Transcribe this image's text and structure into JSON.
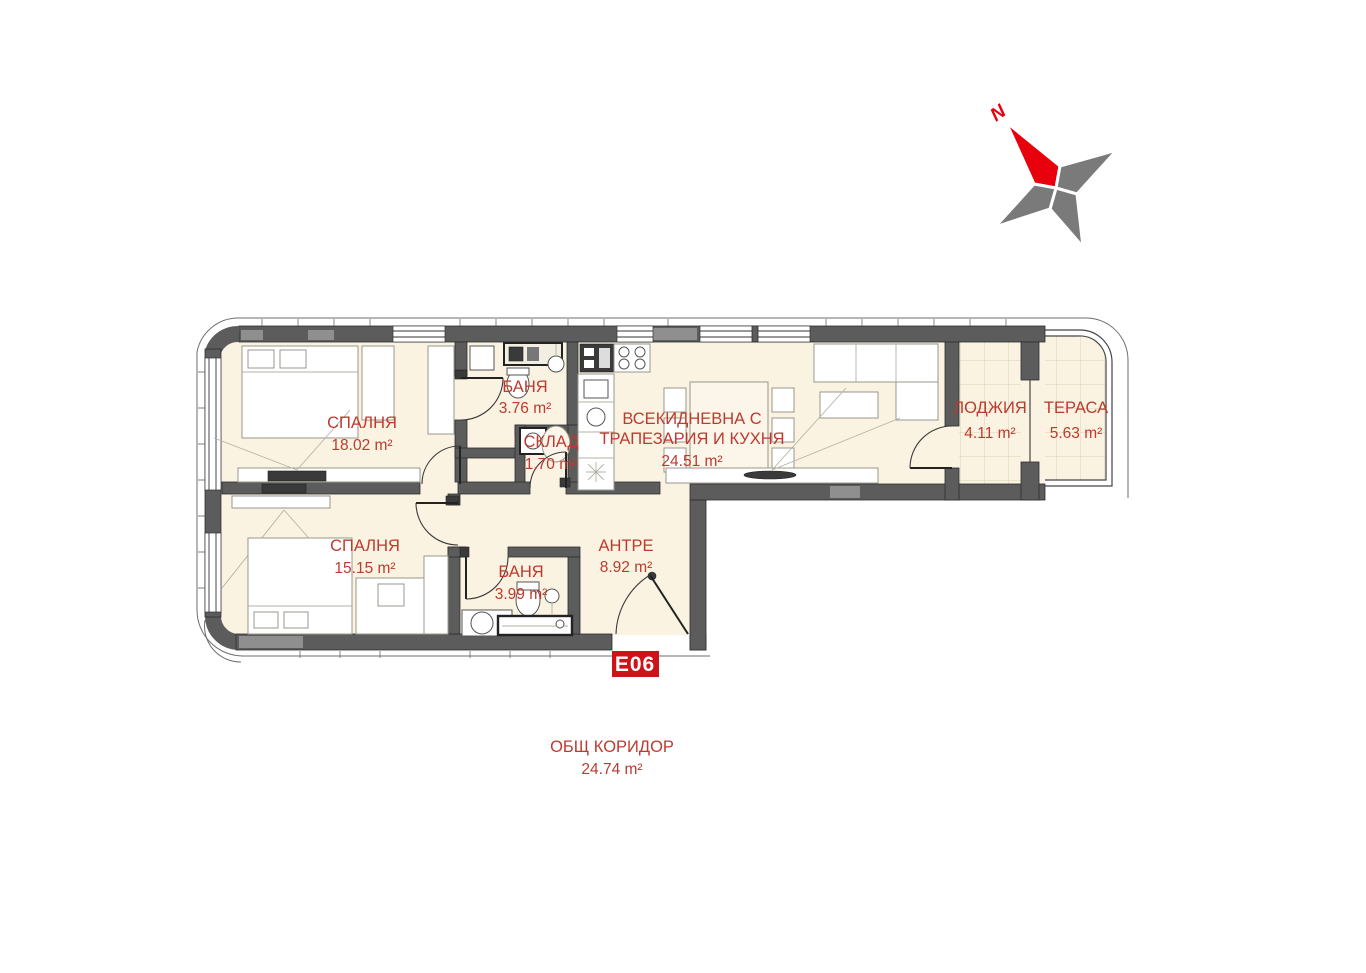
{
  "compass": {
    "north_label": "N"
  },
  "unit_badge": "E06",
  "rooms": {
    "bedroom1": {
      "name": "СПАЛНЯ",
      "area": "18.02 m²"
    },
    "bath1": {
      "name": "БАНЯ",
      "area": "3.76 m²"
    },
    "storage": {
      "name": "СКЛАД",
      "area": "1.70 m²"
    },
    "living": {
      "name_line1": "ВСЕКИДНЕВНА С",
      "name_line2": "ТРАПЕЗАРИЯ И КУХНЯ",
      "area": "24.51 m²"
    },
    "loggia": {
      "name": "ЛОДЖИЯ",
      "area": "4.11 m²"
    },
    "terrace": {
      "name": "ТЕРАСА",
      "area": "5.63 m²"
    },
    "bedroom2": {
      "name": "СПАЛНЯ",
      "area": "15.15 m²"
    },
    "bath2": {
      "name": "БАНЯ",
      "area": "3.99 m²"
    },
    "entry": {
      "name": "АНТРЕ",
      "area": "8.92 m²"
    }
  },
  "corridor": {
    "name": "ОБЩ КОРИДОР",
    "area": "24.74 m²"
  },
  "colors": {
    "label_red": "#BE3A2E",
    "wall_gray": "#5C5C5C",
    "floor_cream": "#FAF3E1",
    "badge_red": "#CC1418",
    "compass_red": "#E8000D",
    "compass_gray": "#7A7A7A"
  }
}
